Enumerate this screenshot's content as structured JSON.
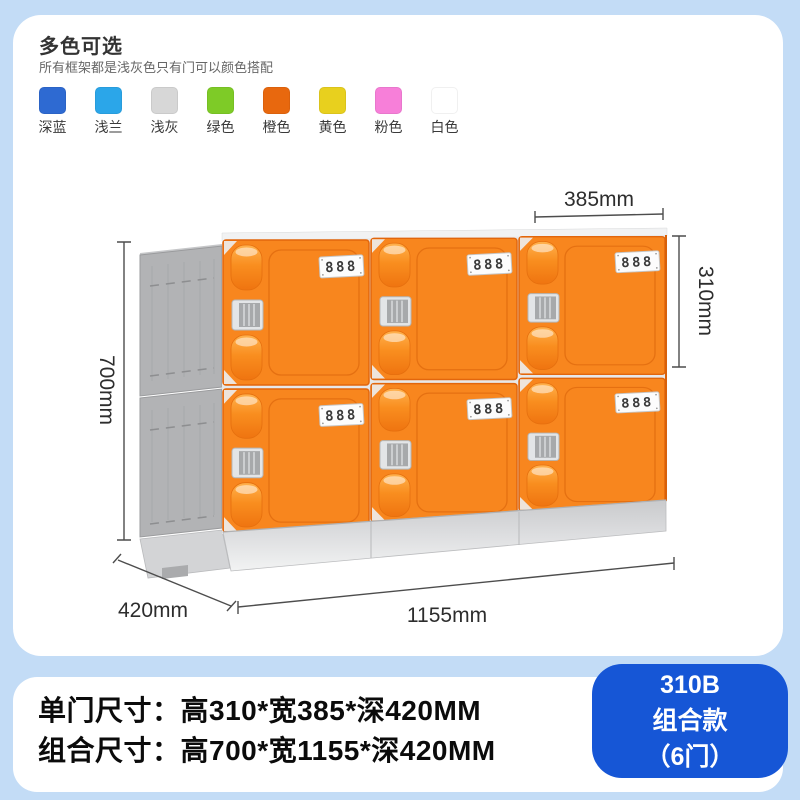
{
  "header": {
    "title": "多色可选",
    "subtitle": "所有框架都是浅灰色只有门可以颜色搭配",
    "swatches": [
      {
        "label": "深蓝",
        "color": "#2e6ad2"
      },
      {
        "label": "浅兰",
        "color": "#2ba6e9"
      },
      {
        "label": "浅灰",
        "color": "#d7d7d7"
      },
      {
        "label": "绿色",
        "color": "#7ecb27"
      },
      {
        "label": "橙色",
        "color": "#e8680e"
      },
      {
        "label": "黄色",
        "color": "#e8d01e"
      },
      {
        "label": "粉色",
        "color": "#f77fd9"
      },
      {
        "label": "白色",
        "color": "#ffffff"
      }
    ]
  },
  "diagram": {
    "door_label": "888",
    "dimensions": {
      "door_width": "385mm",
      "door_height": "310mm",
      "total_height": "700mm",
      "depth": "420mm",
      "total_width": "1155mm"
    },
    "colors": {
      "door_orange": "#f8861e",
      "frame_gray": "#b2b3b5",
      "base_gray": "#dddee0",
      "page_blue": "#c3dcf6",
      "badge_blue": "#1656d6"
    }
  },
  "specs": {
    "single_door": "单门尺寸：高310*宽385*深420MM",
    "combined": "组合尺寸：高700*宽1155*深420MM"
  },
  "badge": {
    "model": "310B",
    "series": "组合款",
    "doors": "（6门）"
  }
}
